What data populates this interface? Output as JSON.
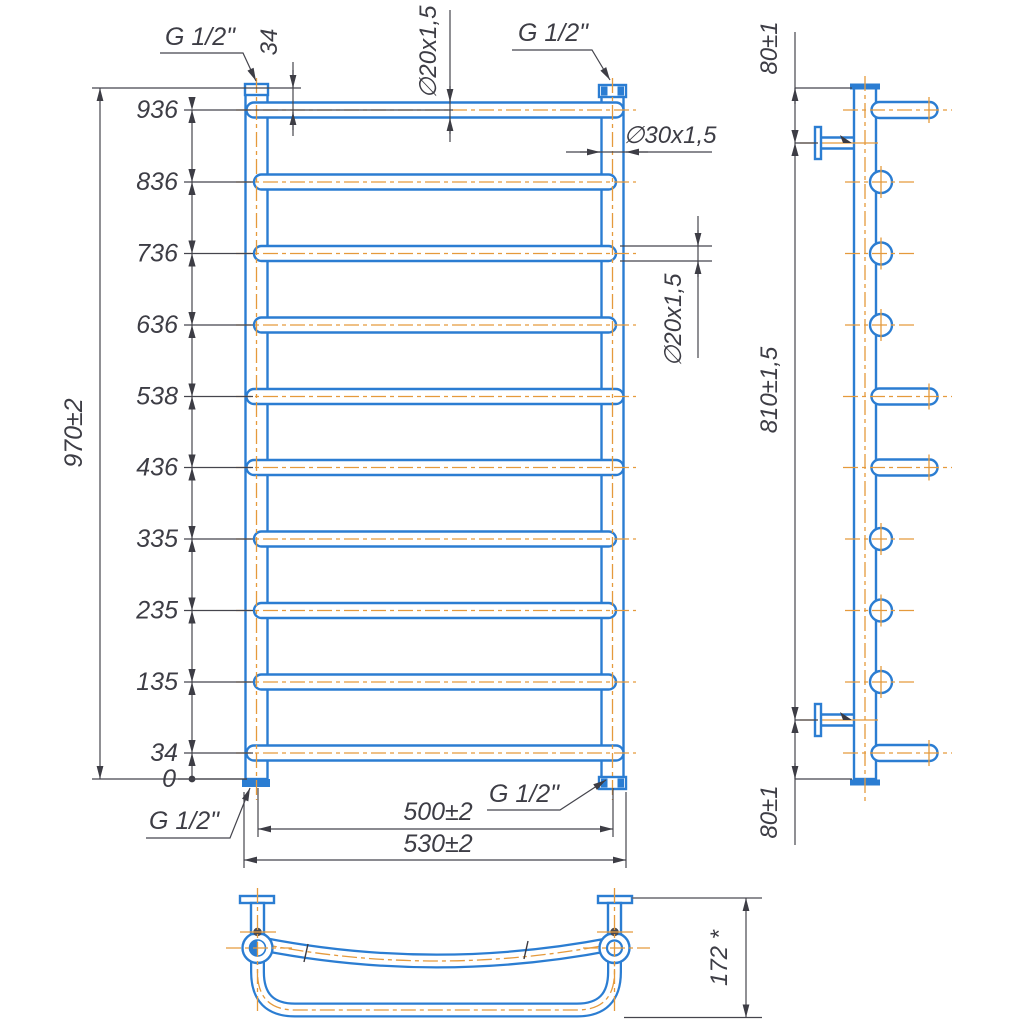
{
  "front_view": {
    "height_labels": [
      "936",
      "836",
      "736",
      "636",
      "538",
      "436",
      "335",
      "235",
      "135",
      "34",
      "0"
    ],
    "overall_height": "970±2",
    "top_rung_offset": "34",
    "rung_tube_top": "∅20x1,5",
    "collector_tube": "∅30x1,5",
    "rung_tube_mid": "∅20x1,5",
    "connection_spacing": "500±2",
    "overall_width": "530±2",
    "thread_top_left": "G 1/2\"",
    "thread_top_right": "G 1/2\"",
    "thread_bottom_left": "G 1/2\"",
    "thread_bottom_right": "G 1/2\""
  },
  "side_view": {
    "top_bracket_offset": "80±1",
    "bracket_spacing": "810±1,5",
    "bottom_bracket_offset": "80±1"
  },
  "top_view": {
    "depth": "172 *"
  },
  "colors": {
    "tube_outline": "#2b7dd2",
    "centerline": "#e59a3c",
    "dimension": "#45454d",
    "background": "#ffffff"
  }
}
